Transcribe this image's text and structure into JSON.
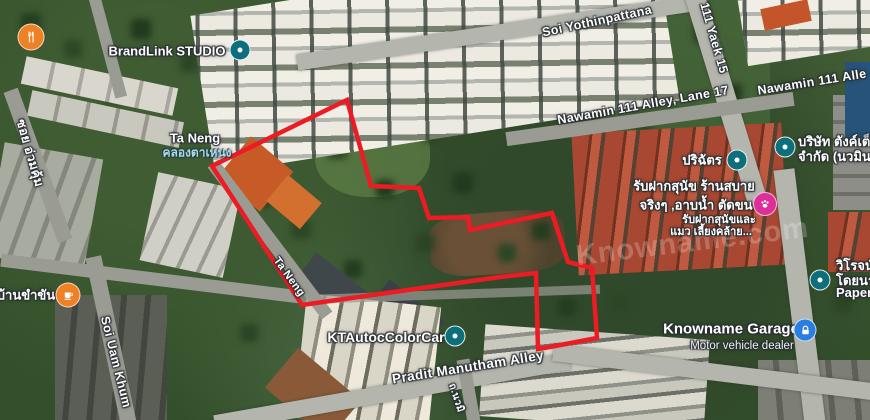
{
  "boundary": {
    "color": "#ed1b24",
    "points": "347,100 371,186 419,188 429,218 468,217 470,230 552,213 568,262 592,268 597,338 550,347 538,349 536,273 500,277 302,305 212,166"
  },
  "watermark": "Knowname.com",
  "colors": {
    "poi_pin": "#0d6e7c",
    "restaurant_pin": "#ee8126",
    "cafe_pin": "#ee8126",
    "pet_pin": "#dd2e9a",
    "garage_pin": "#2a7de1"
  },
  "places": {
    "ta_neng": {
      "label": "Ta Neng",
      "thai": "คลองตาเหนง"
    }
  },
  "streets": {
    "soi_yothinpattana": "Soi Yothinpattana",
    "yaek_15": "111 Yaek 15",
    "nawamin_111_lane_17": "Nawamin 111 Alley, Lane 17",
    "nawamin_111_alley": "Nawamin 111 Alle",
    "soi_uam_khum_en": "Soi Uam Khum",
    "soi_uam_khum_th": "ซอย อ่วมคุ้ม",
    "ta_neng_road": "Ta Neng",
    "pradit_manutham": "Pradit Manutham Alley",
    "nawamin_road_th": "ถ.นวมิ"
  },
  "pois": {
    "brandlink": {
      "label": "BrandLink STUDIO"
    },
    "parichat": {
      "label": "ปริฉัตร"
    },
    "company": {
      "line1": "บริษัท ตังค์เต็",
      "line2": "จำกัด (นวมิน"
    },
    "petshop": {
      "line1": "รับฝากสุนัข ร้านสบาย",
      "line2": "จริงๆ ,อาบน้ำ ตัดขน",
      "line3": "รับฝากสุนัขและ",
      "line4": "แมว เลี้ยงคล้าย..."
    },
    "wirot": {
      "line1": "วิโรจน์",
      "line2": "โดยนา",
      "line3": "Paper"
    },
    "garage": {
      "label": "Knowname Garage",
      "sublabel": "Motor vehicle dealer"
    },
    "ktautoc": {
      "label": "KTAutocColorCar"
    },
    "cafe": {
      "label": "บ้านขำขัน"
    }
  }
}
